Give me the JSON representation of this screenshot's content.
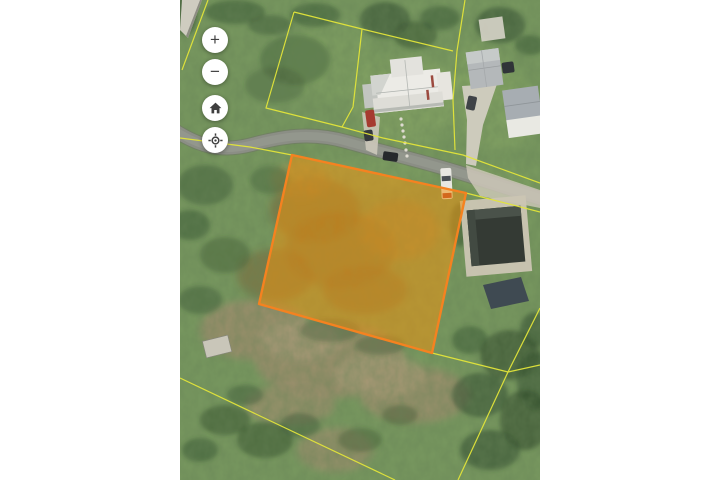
{
  "app": {
    "kind": "satellite-parcel-map-viewer",
    "visible_text": "none — map imagery and icon controls only"
  },
  "layout": {
    "canvas_width": 720,
    "canvas_height": 480,
    "map_left": 180,
    "map_width": 360,
    "map_height": 480,
    "gutter_color": "#ffffff"
  },
  "controls": {
    "zoom_in": {
      "id": "zoom-in",
      "icon": "plus-icon",
      "glyph": "+"
    },
    "zoom_out": {
      "id": "zoom-out",
      "icon": "minus-icon",
      "glyph": "−"
    },
    "home": {
      "id": "home",
      "icon": "home-icon"
    },
    "locate": {
      "id": "locate",
      "icon": "locate-icon"
    },
    "icon_color": "#3f3f3f"
  },
  "palette": {
    "grass": "#78985f",
    "road": "#8b8e85",
    "concrete": "#cfcabc",
    "dirt": "#9d8e6d",
    "tree": "#2e4a2b",
    "boundary_yellow": "#e3e53a",
    "parcel_orange_fill": "#f2930d",
    "parcel_orange_stroke": "#f58220"
  },
  "map_features": {
    "selected_parcel": {
      "points": "112,155 286,193 252,353 79,304",
      "fill": "#f2930d",
      "fill_opacity": "0.52",
      "stroke": "#f58220",
      "stroke_width": "2.4"
    },
    "parcel_line_color": "#e3e53a",
    "parcel_lines": [
      {
        "points": "28,0 2,70"
      },
      {
        "points": "114,12 182,29 173,107 162,127 86,108 114,12"
      },
      {
        "points": "182,29 273,51"
      },
      {
        "points": "285,0 277,51 273,100 275,150"
      },
      {
        "points": "162,127 203,138 283,155 360,183"
      },
      {
        "points": "0,138 70,147 112,155"
      },
      {
        "points": "286,193 360,212"
      },
      {
        "points": "0,378 215,480"
      },
      {
        "points": "252,353 328,372"
      },
      {
        "points": "328,372 360,365"
      },
      {
        "points": "328,372 360,308"
      },
      {
        "points": "328,372 278,480"
      }
    ],
    "road_path": "M -6,130 C 20,147 42,152 70,145 C 100,137 130,131 168,142 C 210,154 250,163 290,176 C 315,184 340,192 366,200"
  }
}
